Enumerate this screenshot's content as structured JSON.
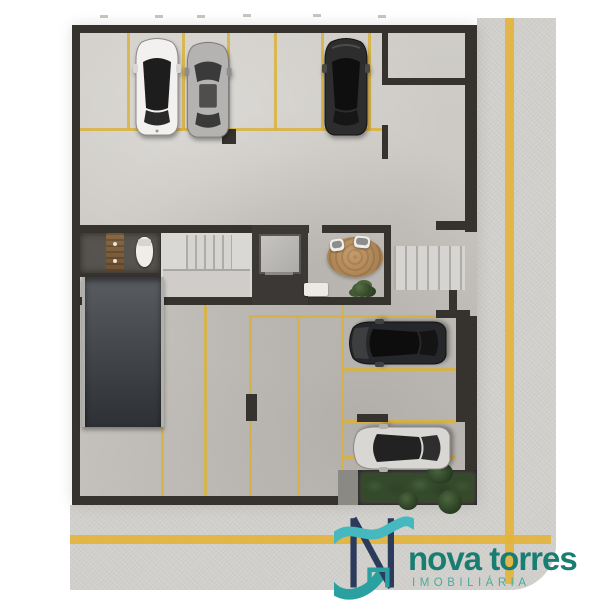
{
  "brand": {
    "title": "nova torres",
    "subtitle": "IMOBILIÁRIA",
    "monogram": "n-monogram-with-teal-swoosh"
  },
  "colors": {
    "background": "#ffffff",
    "floor": "#cdcac5",
    "wall": "#36332f",
    "parking_line": "#d9b13b",
    "road": "#d2d0cc",
    "road_line": "#e3b33c",
    "ramp": "#3f4347",
    "rug": "#b5895c",
    "plant": "#3a512f",
    "logo_navy": "#2c3a5c",
    "logo_teal": "#2aa0a0",
    "logo_cyan": "#45b8c0",
    "logo_title": "#197d72",
    "logo_subtitle": "#4aab9e",
    "car_white": "#f2f1ef",
    "car_silver": "#b4b3b1",
    "car_black": "#2e2d2d",
    "car_suv": "#26272a",
    "car_silver_2": "#d8d7d4"
  },
  "scene": {
    "type": "architectural floor plan, top-down render of parking level",
    "objects": [
      "white-car-top-row",
      "silver-car-top-row",
      "black-car-top-row",
      "dark-suv-right-column",
      "silver-car-right-column",
      "access-ramp",
      "main-staircase",
      "entry-staircase",
      "elevator",
      "wc-toilet",
      "wc-vanity",
      "lobby-rug",
      "lobby-chairs",
      "lobby-plant",
      "planter-garden",
      "street-vertical",
      "street-horizontal",
      "yellow-parking-stripes",
      "yellow-street-center-lines"
    ]
  }
}
